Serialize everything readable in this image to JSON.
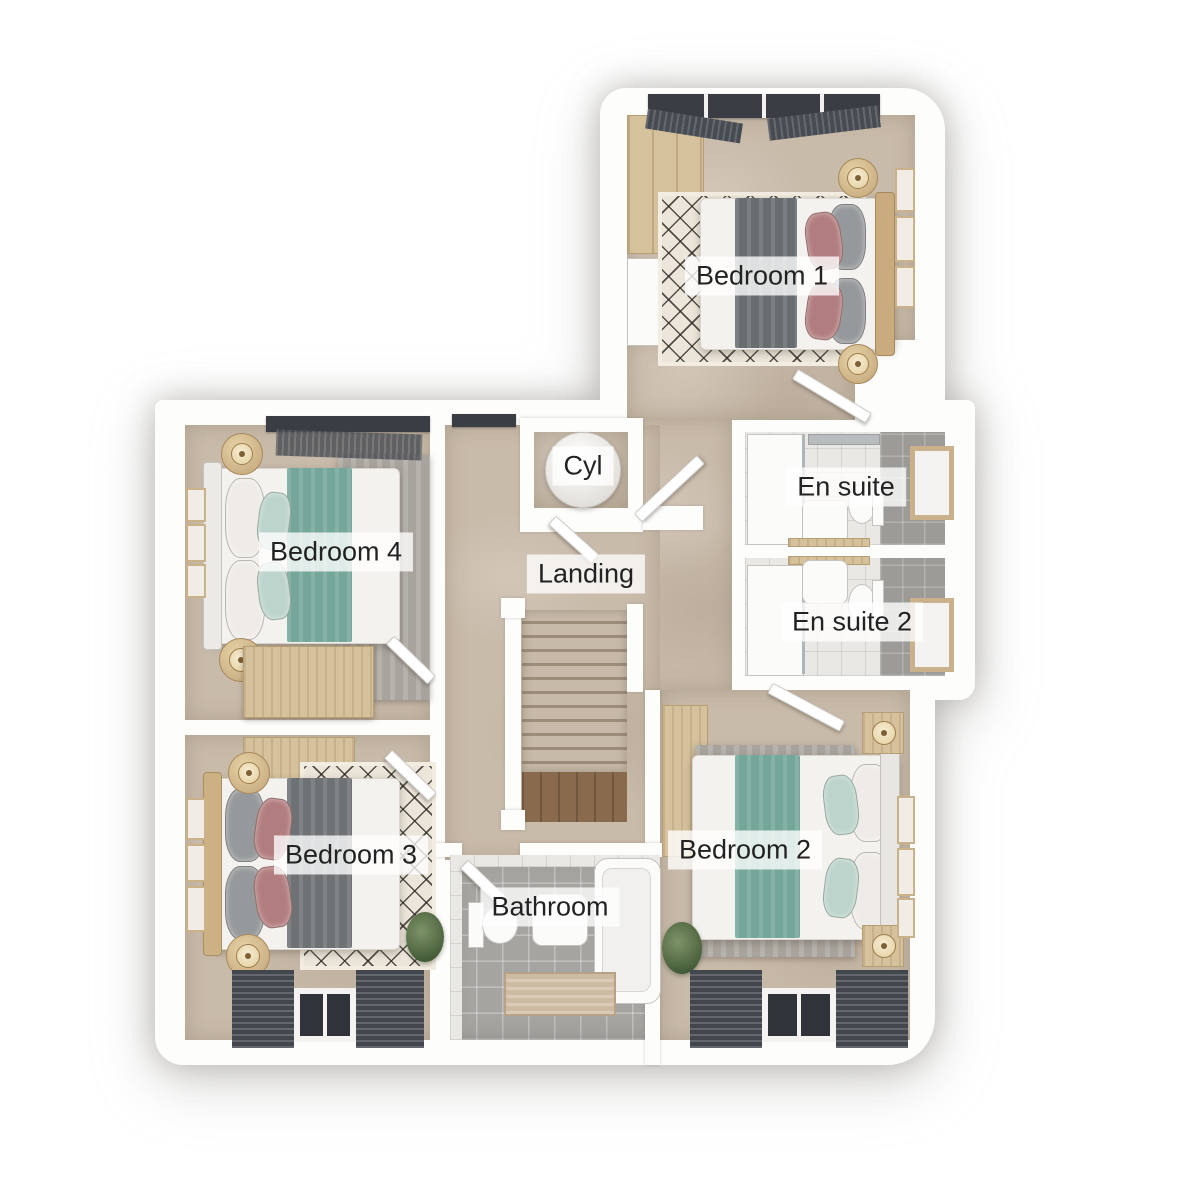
{
  "plan": {
    "name": "First floor plan",
    "rooms": {
      "bedroom1": {
        "label": "Bedroom 1"
      },
      "bedroom2": {
        "label": "Bedroom 2"
      },
      "bedroom3": {
        "label": "Bedroom 3"
      },
      "bedroom4": {
        "label": "Bedroom 4"
      },
      "ensuite": {
        "label": "En suite"
      },
      "ensuite2": {
        "label": "En suite 2"
      },
      "bathroom": {
        "label": "Bathroom"
      },
      "landing": {
        "label": "Landing"
      },
      "cyl": {
        "label": "Cyl"
      }
    },
    "colors": {
      "carpet": "#c9bbaa",
      "tile_gray": "#a6a4a0",
      "wall_white": "#fdfdfc",
      "teal_throw": "#74a79a",
      "gray_throw": "#686d71",
      "pink_pillow": "#b27d7e",
      "wood_light": "#d5c19c",
      "label_bg": "rgba(255,255,255,0.78)",
      "label_text": "#222222"
    }
  }
}
